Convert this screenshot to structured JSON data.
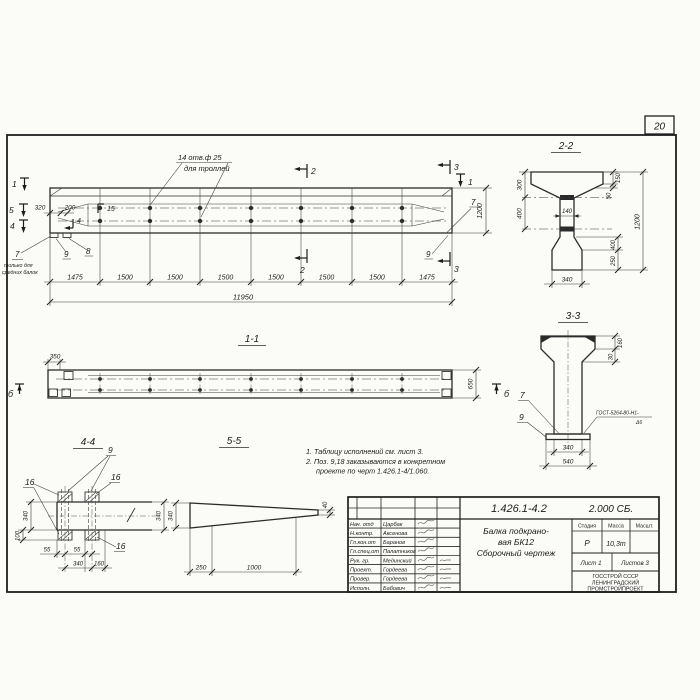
{
  "sheet": {
    "page_number": "20"
  },
  "main_view": {
    "holes_note_line1": "14 отв.ф 25",
    "holes_note_line2": "для троллей",
    "dim_320": "320",
    "dim_200": "200",
    "pos_15": "15",
    "pos_4": "4",
    "cut_1_left": "1",
    "cut_5_left": "5",
    "cut_4_left": "4",
    "cut_1_right": "1",
    "cut_2_top": "2",
    "cut_2_bottom": "2",
    "cut_3_top": "3",
    "cut_3_bottom": "3",
    "dim_1200": "1200",
    "pos_7_right": "7",
    "pos_9_right": "9",
    "pos_9_left": "9",
    "pos_8_left": "8",
    "pos_7_left": "7",
    "pos_7_note_line1": "только для",
    "pos_7_note_line2": "средних балок",
    "chain": [
      "1475",
      "1500",
      "1500",
      "1500",
      "1500",
      "1500",
      "1500",
      "1475"
    ],
    "total": "11950"
  },
  "section11": {
    "title": "1-1",
    "dim_350": "350",
    "dim_650": "650",
    "cut_b_left": "б",
    "cut_b_right": "б"
  },
  "section22": {
    "title": "2-2",
    "dim_300": "300",
    "dim_400_left": "400",
    "dim_150": "150",
    "dim_50": "50",
    "dim_140": "140",
    "dim_1200": "1200",
    "dim_400_right": "400",
    "dim_250": "250",
    "dim_340": "340"
  },
  "section33": {
    "title": "3-3",
    "dim_160": "160",
    "dim_30": "30",
    "pos_7": "7",
    "pos_9": "9",
    "weld_line1": "ГОСТ-5264-80-Н1-",
    "weld_line2": "Δ6",
    "dim_340": "340",
    "dim_540": "540"
  },
  "section44": {
    "title": "4-4",
    "pos_9": "9",
    "pos_16_left": "16",
    "pos_16_right": "16",
    "pos_16_bottom": "16",
    "dim_340_left": "340",
    "dim_100": "100",
    "dim_340_right": "340",
    "dim_55_a": "55",
    "dim_55_b": "55",
    "dim_340_bottom": "340",
    "dim_160": "160"
  },
  "section55": {
    "title": "5-5",
    "dim_340": "340",
    "dim_40": "40",
    "dim_250": "250",
    "dim_1000": "1000"
  },
  "notes": {
    "line1": "1. Таблицу исполнений см. лист 3.",
    "line2": "2. Поз. 9,18 заказываются в конкретном",
    "line3": "проекте по черт 1.426.1-4/1.060."
  },
  "title_block": {
    "doc_number": "1.426.1-4.2",
    "doc_suffix": "2.000 СБ.",
    "title_line1": "Балка подкрано-",
    "title_line2": "вая БК12",
    "title_line3": "Сборочный чертеж",
    "stage_label": "Стадия",
    "mass_label": "Масса",
    "scale_label": "Масшт.",
    "stage_value": "Р",
    "mass_value": "10,3т",
    "sheet_label": "Лист 1",
    "sheets_label": "Листов 3",
    "org_line1": "ГОССТРОЙ СССР",
    "org_line2": "ЛЕНИНГРАДСКИЙ",
    "org_line3": "ПРОМСТРОЙПРОЕКТ",
    "rows": [
      {
        "role": "Нач. отд",
        "name": "Царбак"
      },
      {
        "role": "Н.контр.",
        "name": "Аксенова"
      },
      {
        "role": "Гл.кон.от",
        "name": "Баранов"
      },
      {
        "role": "Гл.спец.от",
        "name": "Палатников"
      },
      {
        "role": "Рук. гр.",
        "name": "Мединский"
      },
      {
        "role": "Проект.",
        "name": "Гордеева"
      },
      {
        "role": "Провер.",
        "name": "Гордеева"
      },
      {
        "role": "Исполн.",
        "name": "Бабович"
      }
    ]
  }
}
